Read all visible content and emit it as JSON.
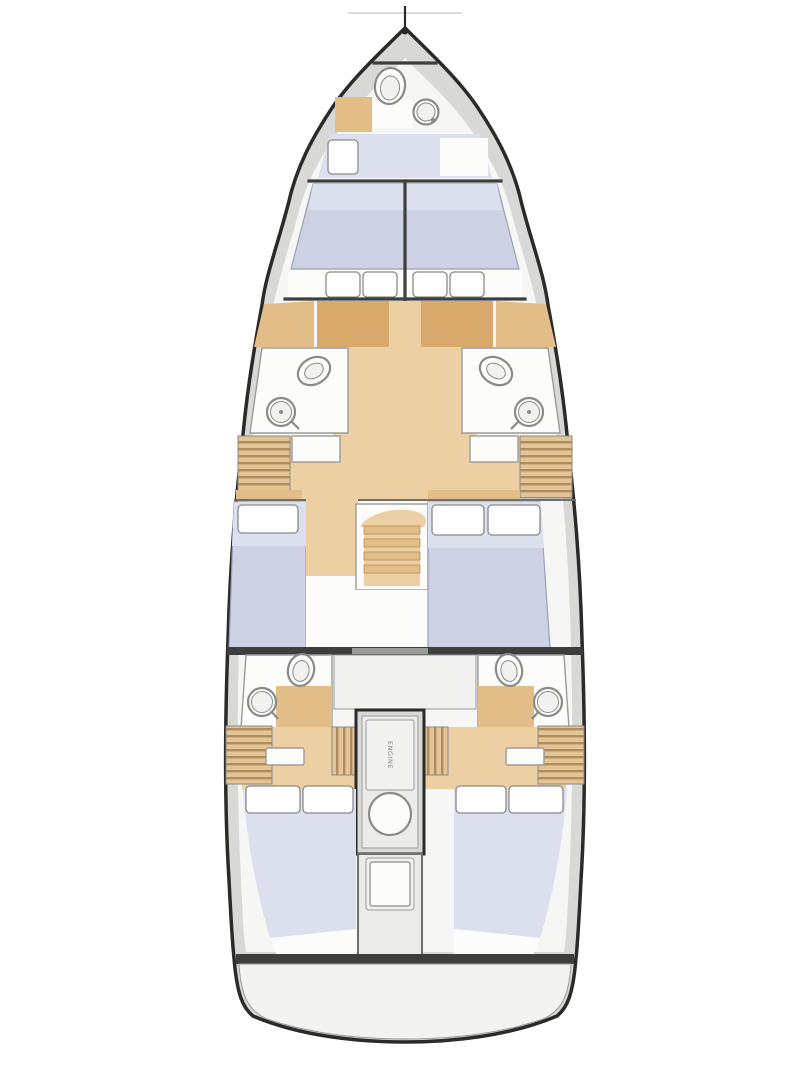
{
  "diagram": {
    "type": "sailing-yacht-interior-deck-plan",
    "orientation": "bow-up",
    "engine_label": "ENGINE",
    "cabins_count": 6,
    "heads_count": 5,
    "fixtures": [
      "toilet-icon",
      "sink-icon",
      "stairs-icon",
      "engine-icon",
      "louver-locker-icon",
      "bed-icon",
      "pillow-icon",
      "mast-foot-icon"
    ],
    "colors": {
      "page_background": "#ffffff",
      "hull_outline": "#2a2a28",
      "deck": "#d8d8d6",
      "interior": "#f6f6f4",
      "room_white": "#fcfcfa",
      "wall": "#9b9b99",
      "wall_dark": "#6f6f6d",
      "wood_floor": "#eccfa2",
      "wood_mid": "#e3bd87",
      "wood_dark": "#d9a96b",
      "slat_light": "#e2c497",
      "slat_dark": "#b08c5a",
      "bed": "#ccd1e3",
      "bed_light": "#dbdfee",
      "bed_stroke": "#9aa0b6",
      "pillow": "#ffffff",
      "fixture_stroke": "#8a8a88",
      "partition": "#3e3e3c",
      "opening": "#9c9c9a",
      "panel": "#ebebe9",
      "panel_light": "#f1f1ef",
      "engine_text": "#88888 6",
      "platform": "#f3f3f1",
      "faint_line": "#dcdcda"
    }
  }
}
